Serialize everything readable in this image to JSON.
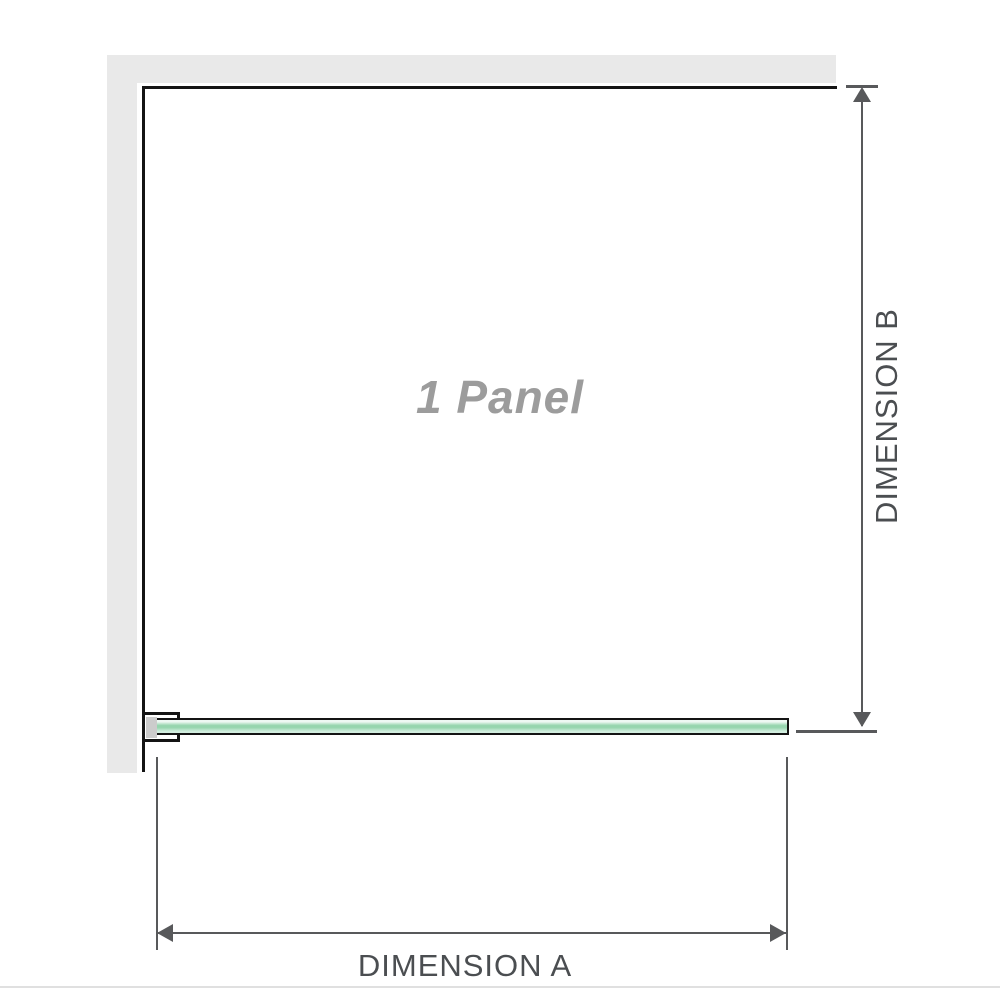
{
  "panel": {
    "label": "1 Panel"
  },
  "dimensions": {
    "a": {
      "label": "DIMENSION A"
    },
    "b": {
      "label": "DIMENSION B"
    }
  },
  "colors": {
    "wall": "#e9e9e9",
    "outline": "#141414",
    "dim": "#58595b",
    "label": "#4b4e51",
    "panel-text": "#9c9c9c",
    "glass-light": "#eef8f3",
    "glass-mid": "#96d5ae",
    "glass-soft": "#d2eedf",
    "bracket-fill": "#cccccc",
    "divider": "#e0e0e0"
  }
}
